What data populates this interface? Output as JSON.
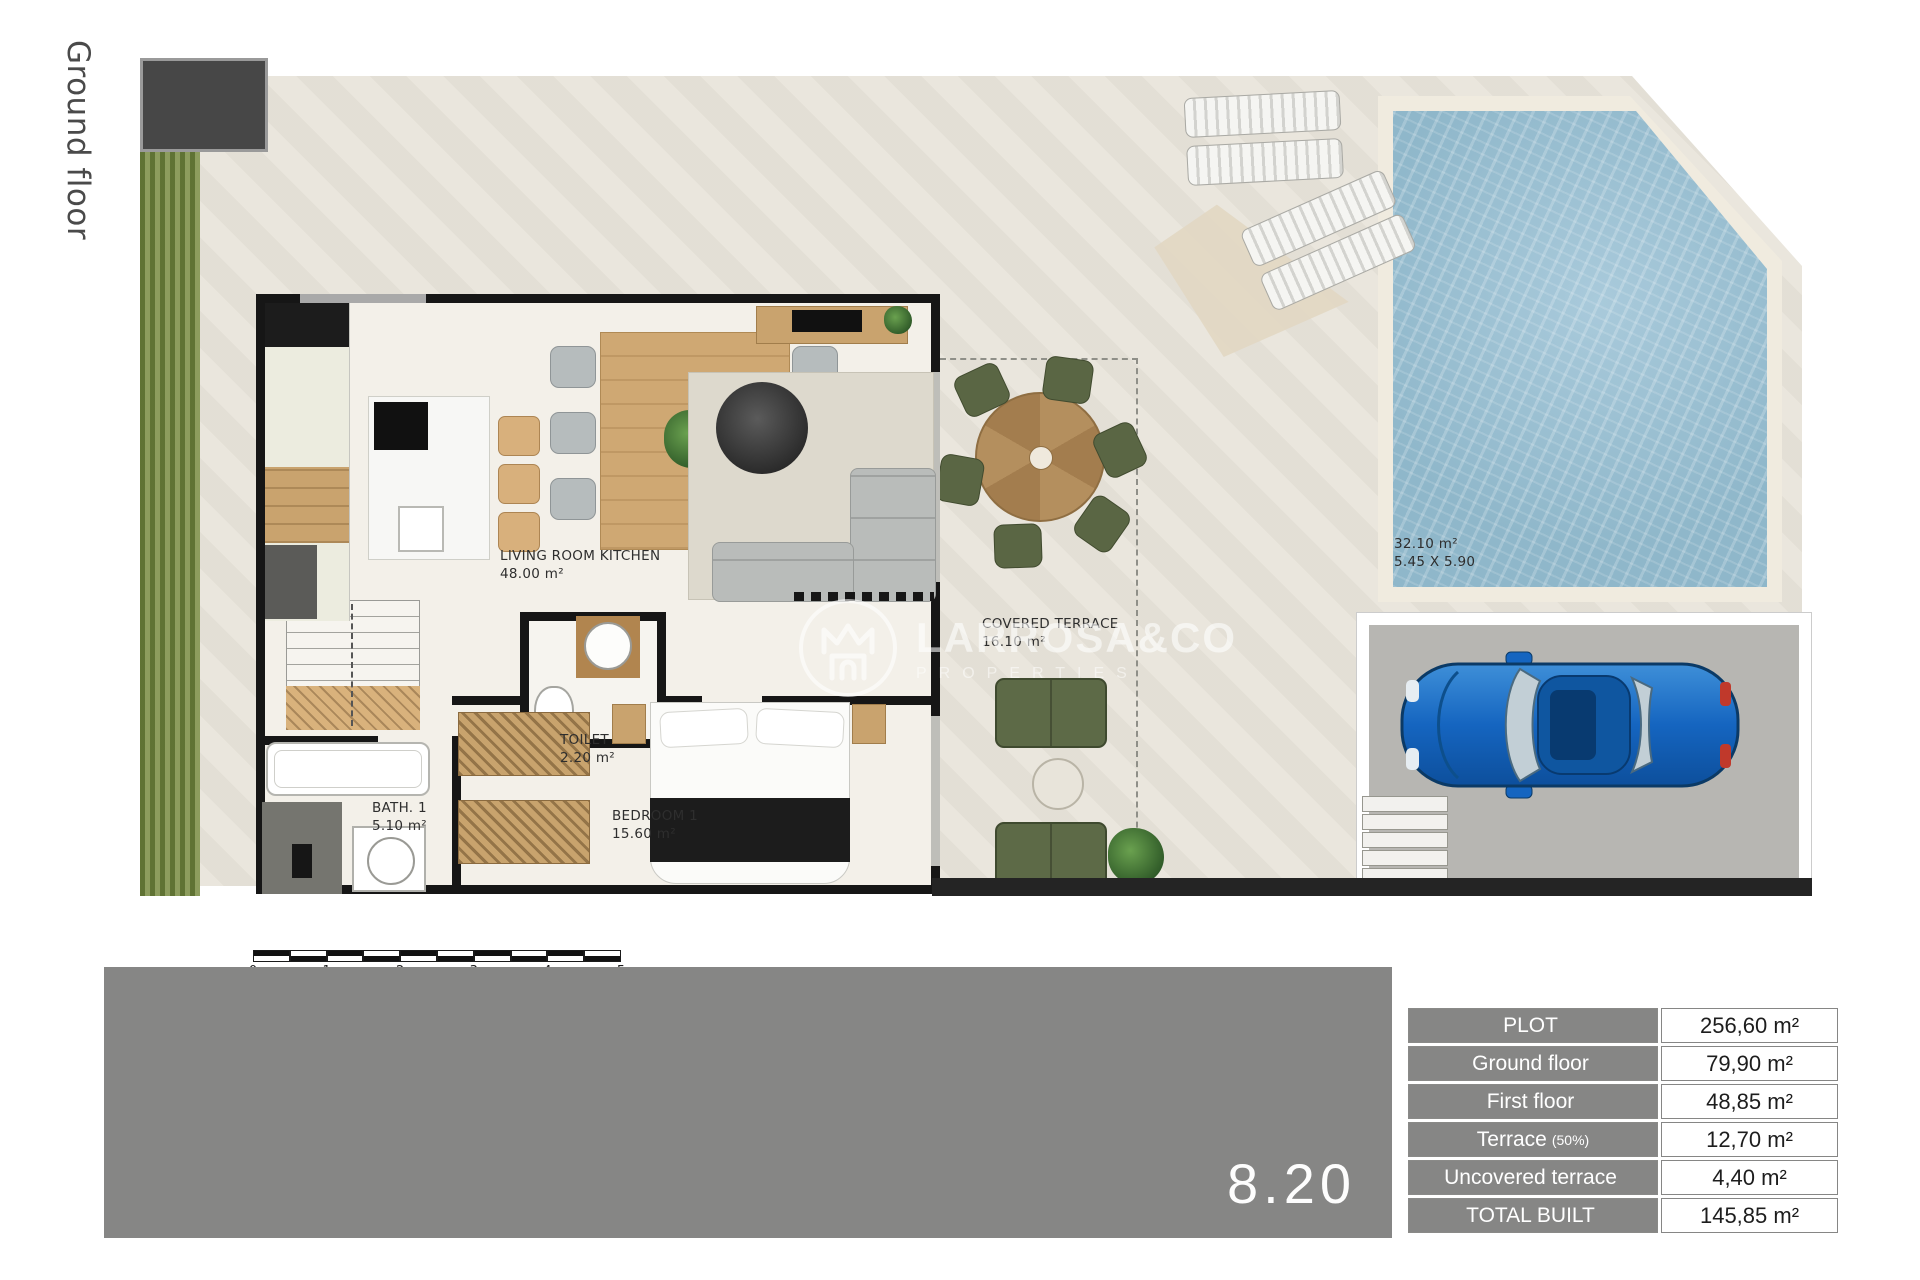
{
  "page": {
    "floor_label": "Ground floor",
    "plan_number": "8.20"
  },
  "watermark": {
    "brand": "LARROSA&CO",
    "subtitle": "PROPERTIES"
  },
  "plan": {
    "rooms": {
      "living": {
        "name": "LIVING ROOM KITCHEN",
        "area": "48.00 m²"
      },
      "toilet": {
        "name": "TOILET",
        "area": "2.20 m²"
      },
      "bath": {
        "name": "BATH. 1",
        "area": "5.10 m²"
      },
      "bedroom": {
        "name": "BEDROOM 1",
        "area": "15.60 m²"
      },
      "terrace": {
        "name": "COVERED TERRACE",
        "area": "16.10 m²"
      }
    },
    "pool": {
      "area": "32.10 m²",
      "dimensions": "5.45 X 5.90"
    },
    "scale": {
      "labels": [
        "0",
        "1",
        "2",
        "3",
        "4",
        "5"
      ]
    }
  },
  "areas_table": {
    "rows": [
      {
        "label": "PLOT",
        "value": "256,60 m²"
      },
      {
        "label": "Ground floor",
        "value": "79,90 m²"
      },
      {
        "label": "First floor",
        "value": "48,85 m²"
      },
      {
        "label": "Terrace",
        "suffix": "(50%)",
        "value": "12,70 m²"
      },
      {
        "label": "Uncovered terrace",
        "value": "4,40 m²"
      },
      {
        "label": "TOTAL BUILT",
        "value": "145,85 m²"
      }
    ]
  },
  "colors": {
    "bar_gray": "#868685",
    "plot_beige": "#e9e5dc",
    "pool_water": "#9cc0d2",
    "grass_green": "#7d9048",
    "terrace_green": "#5d6a47",
    "car_blue": "#1565c0",
    "wood": "#c9a36e"
  }
}
